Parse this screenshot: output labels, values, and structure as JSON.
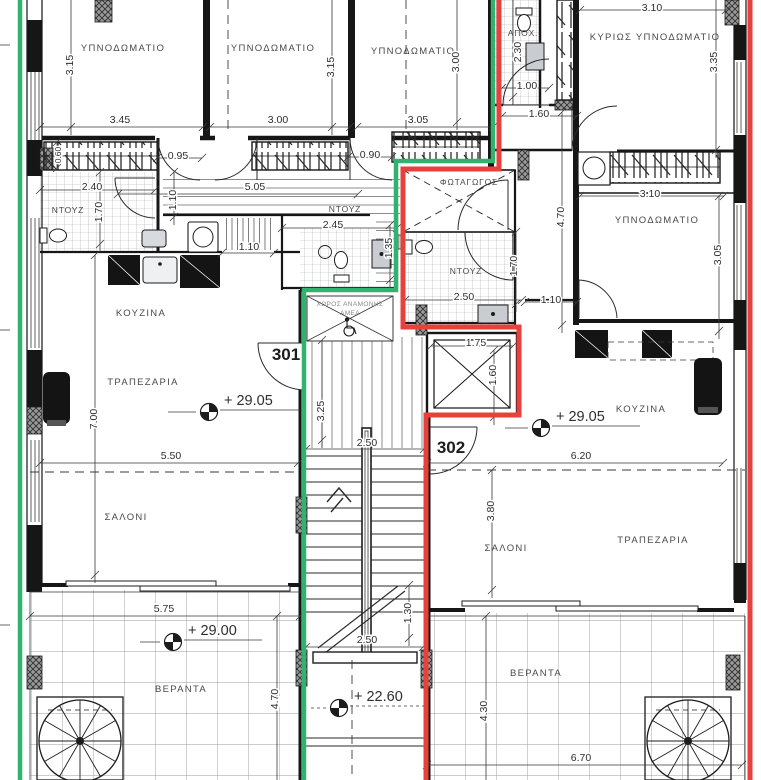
{
  "drawing_title": "Apartment floor plan – units 301 / 302",
  "colors": {
    "unit301_boundary": "#2fb36e",
    "unit302_boundary": "#e8403c",
    "walls": "#161616"
  },
  "units": {
    "u301": "301",
    "u302": "302"
  },
  "rooms": {
    "bed1": "ΥΠΝΟΔΩΜΑΤΙΟ",
    "bed2": "ΥΠΝΟΔΩΜΑΤΙΟ",
    "bed3": "ΥΠΝΟΔΩΜΑΤΙΟ",
    "master": "ΚΥΡΙΩΣ ΥΠΝΟΔΩΜΑΤΙΟ",
    "bed4": "ΥΠΝΟΔΩΜΑΤΙΟ",
    "sewage": "ΑΠΟΧ.",
    "lightwell": "ΦΩΤΑΓΩΓΟΣ",
    "shower1": "ΝΤΟΥΖ",
    "shower2": "ΝΤΟΥΖ",
    "shower3": "ΝΤΟΥΖ",
    "kitchen1": "ΚΟΥΖΙΝΑ",
    "kitchen2": "ΚΟΥΖΙΝΑ",
    "dining1": "ΤΡΑΠΕΖΑΡΙΑ",
    "dining2": "ΤΡΑΠΕΖΑΡΙΑ",
    "living1": "ΣΑΛΟΝΙ",
    "living2": "ΣΑΛΟΝΙ",
    "veranda1": "ΒΕΡΑΝΤΑ",
    "veranda2": "ΒΕΡΑΝΤΑ",
    "wait1": "ΧΩΡΟΣ ΑΝΑΜΟΝΗΣ",
    "wait2": "ΑΜΕΑ"
  },
  "levels": {
    "l2905a": "+ 29.05",
    "l2905b": "+ 29.05",
    "l2900": "+ 29.00",
    "l2260": "+ 22.60"
  },
  "dims": {
    "d060": "0.60",
    "d090": "0.90",
    "d095": "0.95",
    "d100": "1.00",
    "d110a": "1.10",
    "d110b": "1.10",
    "d110c": "1.10",
    "d130": "1.30",
    "d135": "1.35",
    "d160a": "1.60",
    "d160b": "1.60",
    "d170a": "1.70",
    "d170b": "1.70",
    "d175": "1.75",
    "d230": "2.30",
    "d240": "2.40",
    "d245": "2.45",
    "d250a": "2.50",
    "d250b": "2.50",
    "d250c": "2.50",
    "d300a": "3.00",
    "d300b": "3.00",
    "d305a": "3.05",
    "d305b": "3.05",
    "d310a": "3.10",
    "d310b": "3.10",
    "d315a": "3.15",
    "d315b": "3.15",
    "d325": "3.25",
    "d335": "3.35",
    "d345": "3.45",
    "d380": "3.80",
    "d430": "4.30",
    "d470a": "4.70",
    "d470b": "4.70",
    "d505": "5.05",
    "d550": "5.50",
    "d575": "5.75",
    "d620": "6.20",
    "d670": "6.70",
    "d700": "7.00"
  }
}
